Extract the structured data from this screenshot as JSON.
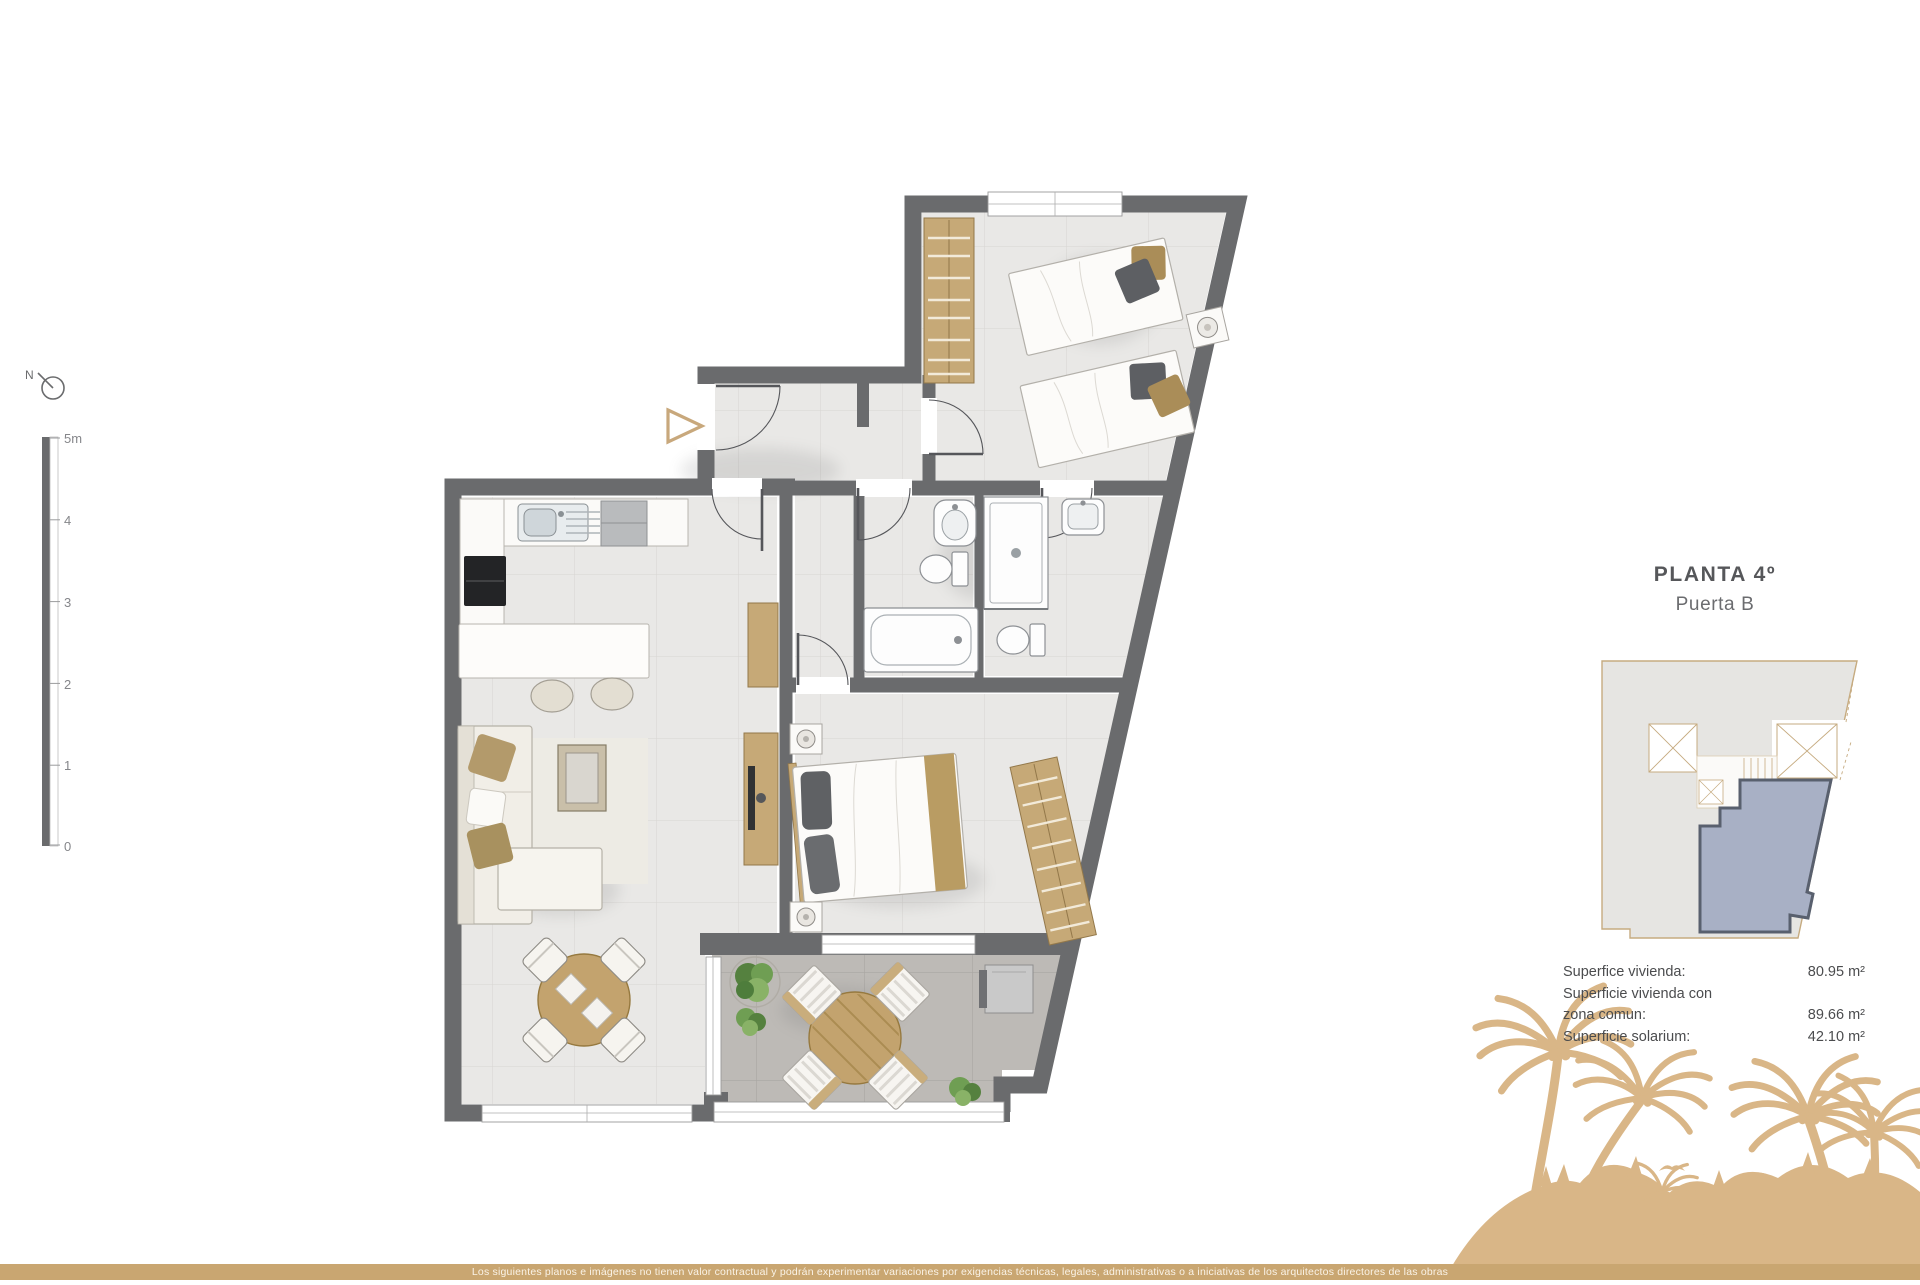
{
  "north_label": "N",
  "scale_bar": {
    "labels": [
      "5m",
      "4",
      "3",
      "2",
      "1",
      "0"
    ]
  },
  "panel": {
    "title": "PLANTA 4º",
    "subtitle": "Puerta B"
  },
  "areas": {
    "rows": [
      {
        "label": "Superfice vivienda:",
        "value": "80.95 m²"
      },
      {
        "label": "Superficie vivienda con",
        "value": ""
      },
      {
        "label": "zona comun:",
        "value": "89.66 m²"
      },
      {
        "label": "Superficie solarium:",
        "value": "42.10 m²"
      }
    ]
  },
  "disclaimer": "Los siguientes planos e imágenes no tienen valor contractual y podrán experimentar variaciones por exigencias técnicas, legales, administrativas o a iniciativas de los arquitectos directores de las obras",
  "icons": {
    "entrance_marker": "triangle-outline",
    "north_indicator": "compass-circle",
    "birds": "seagull-silhouette"
  },
  "colors": {
    "accent_gold": "#c8a87c",
    "bar_gold": "#c9a671",
    "palm_tan": "#d9b687",
    "wall_gray": "#6a6b6d",
    "floor_light": "#e9e8e6",
    "terrace_gray": "#bdbab6",
    "wood": "#c3a36e",
    "wardrobe_wood": "#c6a977",
    "unit_blue": "#a8b0c5",
    "unit_border": "#59606e",
    "keyplan_fill": "#e6e5e2",
    "keyplan_line": "#c6ab80",
    "title_text": "#56575a",
    "body_text": "#4b4c4e",
    "plant_green": "#6f9e53"
  }
}
